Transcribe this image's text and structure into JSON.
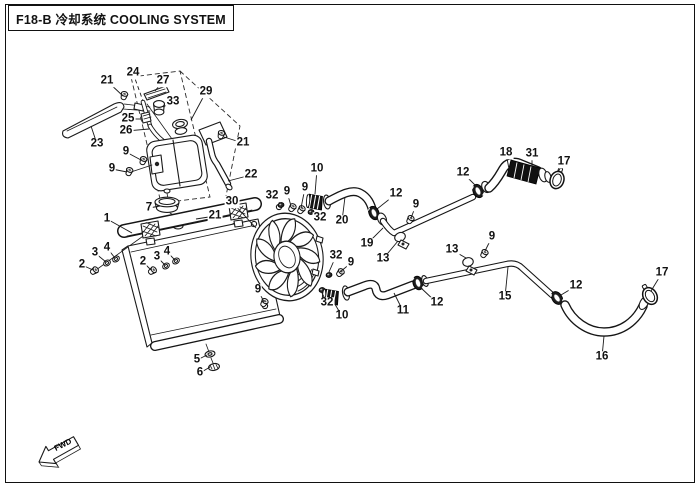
{
  "header": {
    "title": "F18-B 冷却系统 COOLING SYSTEM"
  },
  "footer": {
    "fwd_label": "FWD"
  },
  "diagram": {
    "callouts": [
      {
        "n": "21",
        "x": 107,
        "y": 81,
        "tx": 123,
        "ty": 96
      },
      {
        "n": "24",
        "x": 133,
        "y": 73,
        "tx": 143,
        "ty": 101,
        "dash": true
      },
      {
        "n": "27",
        "x": 163,
        "y": 81,
        "tx": 155,
        "ty": 91
      },
      {
        "n": "29",
        "x": 206,
        "y": 92,
        "tx": 191,
        "ty": 120
      },
      {
        "n": "33",
        "x": 173,
        "y": 102,
        "tx": 163,
        "ty": 107
      },
      {
        "n": "25",
        "x": 128,
        "y": 119,
        "tx": 141,
        "ty": 119
      },
      {
        "n": "26",
        "x": 126,
        "y": 131,
        "tx": 149,
        "ty": 129
      },
      {
        "n": "23",
        "x": 97,
        "y": 144,
        "tx": 91,
        "ty": 126
      },
      {
        "n": "9",
        "x": 126,
        "y": 152,
        "tx": 141,
        "ty": 160
      },
      {
        "n": "9",
        "x": 112,
        "y": 169,
        "tx": 127,
        "ty": 172
      },
      {
        "n": "21",
        "x": 243,
        "y": 143,
        "tx": 224,
        "ty": 137
      },
      {
        "n": "22",
        "x": 251,
        "y": 175,
        "tx": 228,
        "ty": 181
      },
      {
        "n": "30",
        "x": 232,
        "y": 202,
        "tx": 256,
        "ty": 228
      },
      {
        "n": "7",
        "x": 149,
        "y": 208,
        "tx": 160,
        "ty": 206
      },
      {
        "n": "21",
        "x": 215,
        "y": 216,
        "tx": 196,
        "ty": 219
      },
      {
        "n": "1",
        "x": 107,
        "y": 219,
        "tx": 132,
        "ty": 233
      },
      {
        "n": "3",
        "x": 95,
        "y": 253,
        "tx": 106,
        "ty": 262
      },
      {
        "n": "4",
        "x": 107,
        "y": 248,
        "tx": 115,
        "ty": 258
      },
      {
        "n": "2",
        "x": 82,
        "y": 265,
        "tx": 93,
        "ty": 270
      },
      {
        "n": "2",
        "x": 143,
        "y": 262,
        "tx": 151,
        "ty": 270
      },
      {
        "n": "3",
        "x": 157,
        "y": 257,
        "tx": 165,
        "ty": 265
      },
      {
        "n": "4",
        "x": 167,
        "y": 252,
        "tx": 175,
        "ty": 260
      },
      {
        "n": "5",
        "x": 197,
        "y": 360,
        "tx": 207,
        "ty": 355
      },
      {
        "n": "6",
        "x": 200,
        "y": 373,
        "tx": 210,
        "ty": 367
      },
      {
        "n": "9",
        "x": 258,
        "y": 290,
        "tx": 264,
        "ty": 302
      },
      {
        "n": "32",
        "x": 272,
        "y": 196,
        "tx": 280,
        "ty": 203
      },
      {
        "n": "9",
        "x": 287,
        "y": 192,
        "tx": 291,
        "ty": 206
      },
      {
        "n": "9",
        "x": 305,
        "y": 188,
        "tx": 301,
        "ty": 208
      },
      {
        "n": "10",
        "x": 317,
        "y": 169,
        "tx": 315,
        "ty": 194
      },
      {
        "n": "32",
        "x": 320,
        "y": 218,
        "tx": 311,
        "ty": 212
      },
      {
        "n": "20",
        "x": 342,
        "y": 221,
        "tx": 345,
        "ty": 197
      },
      {
        "n": "19",
        "x": 367,
        "y": 244,
        "tx": 383,
        "ty": 228
      },
      {
        "n": "13",
        "x": 383,
        "y": 259,
        "tx": 398,
        "ty": 241
      },
      {
        "n": "12",
        "x": 396,
        "y": 194,
        "tx": 377,
        "ty": 209
      },
      {
        "n": "9",
        "x": 416,
        "y": 205,
        "tx": 411,
        "ty": 218
      },
      {
        "n": "12",
        "x": 463,
        "y": 173,
        "tx": 477,
        "ty": 187
      },
      {
        "n": "18",
        "x": 506,
        "y": 153,
        "tx": 509,
        "ty": 169
      },
      {
        "n": "31",
        "x": 532,
        "y": 154,
        "tx": 532,
        "ty": 166
      },
      {
        "n": "17",
        "x": 564,
        "y": 162,
        "tx": 558,
        "ty": 172
      },
      {
        "n": "13",
        "x": 452,
        "y": 250,
        "tx": 466,
        "ty": 258
      },
      {
        "n": "9",
        "x": 492,
        "y": 237,
        "tx": 485,
        "ty": 251
      },
      {
        "n": "15",
        "x": 505,
        "y": 297,
        "tx": 508,
        "ty": 267
      },
      {
        "n": "12",
        "x": 437,
        "y": 303,
        "tx": 420,
        "ty": 287
      },
      {
        "n": "11",
        "x": 403,
        "y": 311,
        "tx": 394,
        "ty": 293
      },
      {
        "n": "10",
        "x": 342,
        "y": 316,
        "tx": 333,
        "ty": 301
      },
      {
        "n": "32",
        "x": 327,
        "y": 303,
        "tx": 322,
        "ty": 293
      },
      {
        "n": "32",
        "x": 336,
        "y": 256,
        "tx": 329,
        "ty": 272
      },
      {
        "n": "9",
        "x": 351,
        "y": 263,
        "tx": 340,
        "ty": 272
      },
      {
        "n": "12",
        "x": 576,
        "y": 286,
        "tx": 561,
        "ty": 295
      },
      {
        "n": "17",
        "x": 662,
        "y": 273,
        "tx": 651,
        "ty": 291
      },
      {
        "n": "16",
        "x": 602,
        "y": 357,
        "tx": 604,
        "ty": 336
      }
    ]
  }
}
